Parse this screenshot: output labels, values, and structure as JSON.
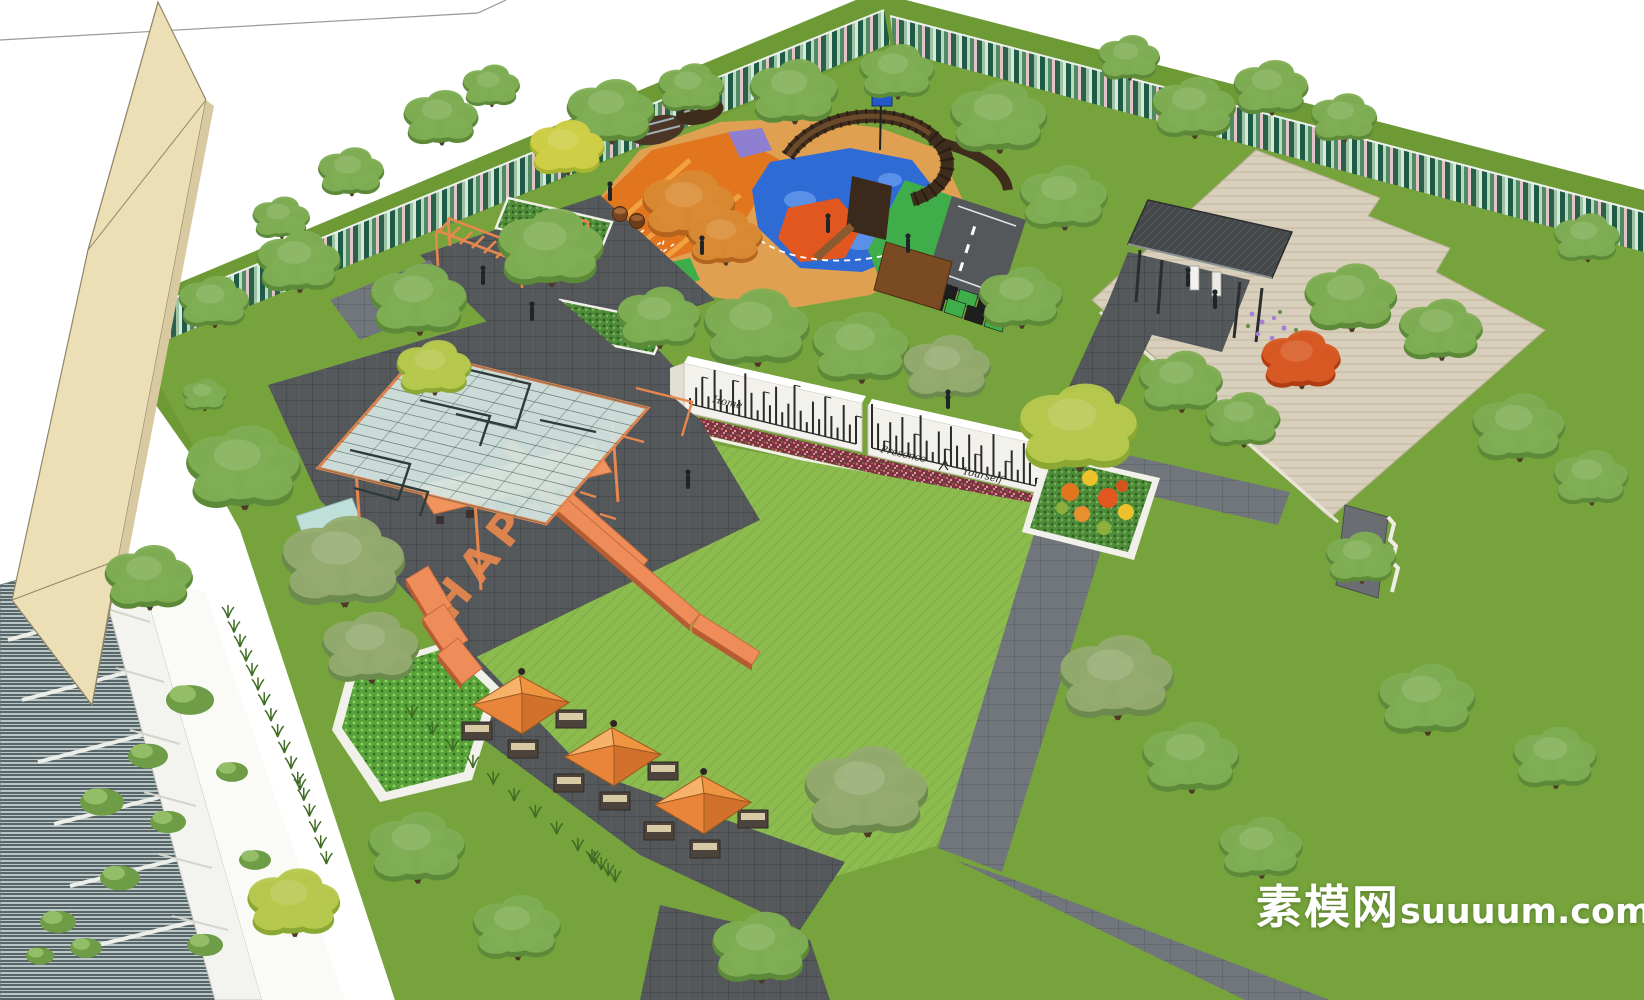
{
  "meta": {
    "description": "Aerial 3D rendering of a community park landscape design",
    "render_style": "SketchUp-style perspective"
  },
  "watermark": {
    "cn": "素模网",
    "latin": "suuuum.com",
    "color": "#ffffff"
  },
  "ground_texts": {
    "plaza_word": "HAPPY"
  },
  "mural": {
    "art": "city-skyline-line-art",
    "words": [
      "Home",
      "Presence",
      "Yourself"
    ]
  },
  "palette": {
    "sky": "#ffffff",
    "lawn": "#77a33c",
    "lawnBright": "#8cbb4e",
    "lawnDark": "#6d9a35",
    "forestDeep": "#2f6b4f",
    "pavingDark": "#54585b",
    "pavingMid": "#70767b",
    "stone": "#d8d0bc",
    "stoneLine": "#c3b89f",
    "orange": "#e8874d",
    "orangeDeep": "#d06c2e",
    "wood": "#3e2c1c",
    "cream": "#ecdfb6",
    "glass": "#b9c6c6",
    "mural": "#f3f1ec",
    "hedge": "#4e8c3a",
    "flowerBed": "#7e3340",
    "playBlue": "#2f6bd4",
    "playGreen": "#3fae4a",
    "playOrange": "#e2761f",
    "playRed": "#e2561f",
    "sand": "#dfa052",
    "roof": "#45484a",
    "track": "#55585a",
    "purple": "#a77fd4"
  }
}
